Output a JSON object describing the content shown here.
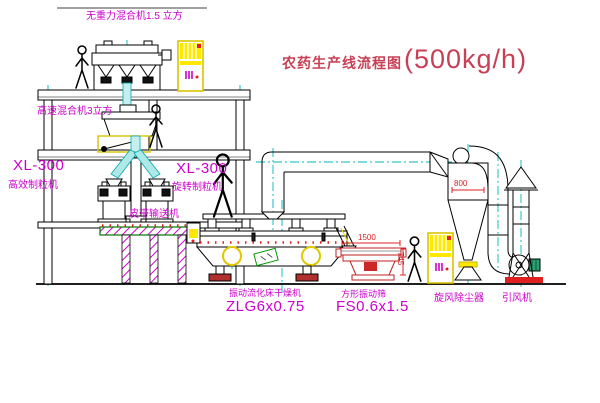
{
  "title": {
    "name": "农药生产线流程图",
    "capacity": "(500kg/h)"
  },
  "labels": {
    "gravity_mixer": "无重力混合机1.5 立方",
    "high_speed_mixer": "高速混合机3立方",
    "granulator_left_model": "XL-300",
    "granulator_left_name": "高效制粒机",
    "granulator_right_model": "XL-300",
    "granulator_right_name": "旋转制粒机",
    "belt_conveyor": "皮带输送机",
    "dryer_name": "振动流化床干燥机",
    "dryer_model": "ZLG6x0.75",
    "screen_name": "方形振动筛",
    "screen_model": "FS0.6x1.5",
    "cyclone": "旋风除尘器",
    "fan": "引风机"
  },
  "dimensions": {
    "screen_length": "1500",
    "screen_height": "745",
    "cyclone_diameter": "800"
  },
  "colors": {
    "label_magenta": "#cc00cc",
    "title_red": "#c84055",
    "line_black": "#000000",
    "centerline_cyan": "#00b8b8",
    "equipment_yellow": "#ffe800",
    "accent_red": "#e02020",
    "accent_green": "#009900"
  }
}
